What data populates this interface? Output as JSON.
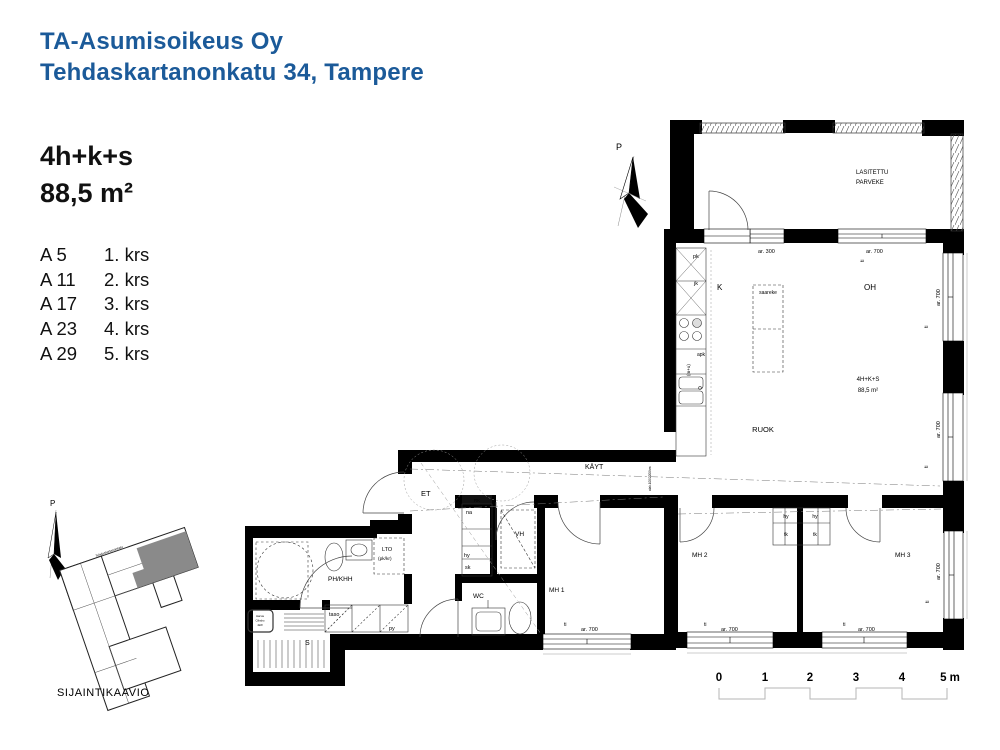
{
  "header": {
    "company": "TA-Asumisoikeus Oy",
    "address": "Tehdaskartanonkatu 34, Tampere"
  },
  "unit": {
    "type": "4h+k+s",
    "area": "88,5 m²"
  },
  "floors": [
    {
      "apt": "A 5",
      "floor": "1. krs"
    },
    {
      "apt": "A 11",
      "floor": "2. krs"
    },
    {
      "apt": "A 17",
      "floor": "3. krs"
    },
    {
      "apt": "A 23",
      "floor": "4. krs"
    },
    {
      "apt": "A 29",
      "floor": "5. krs"
    }
  ],
  "colors": {
    "accent_blue": "#1b5a99",
    "wall_black": "#000000",
    "site_highlight": "#8a8a8a"
  },
  "plan": {
    "labels": [
      {
        "name": "north-arrow-label",
        "text": "P",
        "x": 616,
        "y": 150,
        "size": 9
      },
      {
        "name": "balcony-label-line1",
        "text": "LASITETTU",
        "x": 856,
        "y": 174,
        "size": 6
      },
      {
        "name": "balcony-label-line2",
        "text": "PARVEKE",
        "x": 856,
        "y": 184,
        "size": 6
      },
      {
        "name": "dim-ar300",
        "text": "ar. 300",
        "x": 758,
        "y": 253,
        "size": 5.5
      },
      {
        "name": "dim-ar700-top",
        "text": "ar. 700",
        "x": 866,
        "y": 253,
        "size": 5.5
      },
      {
        "name": "sill-ti-top",
        "text": "ti",
        "x": 864,
        "y": 262,
        "size": 5,
        "rot": -90
      },
      {
        "name": "kitchen-freezer-label",
        "text": "pk",
        "x": 693,
        "y": 258,
        "size": 5.5
      },
      {
        "name": "kitchen-fridge-label",
        "text": "jk",
        "x": 694,
        "y": 285,
        "size": 5.5
      },
      {
        "name": "kitchen-label",
        "text": "K",
        "x": 717,
        "y": 290,
        "size": 8
      },
      {
        "name": "island-label",
        "text": "saareke",
        "x": 768,
        "y": 294,
        "size": 5,
        "anchor": "middle"
      },
      {
        "name": "livingroom-label",
        "text": "OH",
        "x": 864,
        "y": 290,
        "size": 8
      },
      {
        "name": "dishwasher-label",
        "text": "apk",
        "x": 697,
        "y": 356,
        "size": 5
      },
      {
        "name": "oven-micro-label",
        "text": "(m+u)",
        "x": 690,
        "y": 376,
        "size": 4.5,
        "rot": -90
      },
      {
        "name": "dim-ar700-right1",
        "text": "ar. 700",
        "x": 940,
        "y": 306,
        "size": 5.5,
        "rot": -90
      },
      {
        "name": "sill-ti-right1",
        "text": "ti",
        "x": 928,
        "y": 328,
        "size": 5,
        "rot": -90
      },
      {
        "name": "apartment-type-label",
        "text": "4H+K+S",
        "x": 868,
        "y": 381,
        "size": 6,
        "anchor": "middle"
      },
      {
        "name": "apartment-area-label",
        "text": "88,5 m²",
        "x": 868,
        "y": 392,
        "size": 6,
        "anchor": "middle"
      },
      {
        "name": "dining-label",
        "text": "RUOK",
        "x": 763,
        "y": 432,
        "size": 7.5,
        "anchor": "middle"
      },
      {
        "name": "dim-ar700-right2",
        "text": "ar. 700",
        "x": 940,
        "y": 438,
        "size": 5.5,
        "rot": -90
      },
      {
        "name": "sill-ti-right2",
        "text": "ti",
        "x": 928,
        "y": 468,
        "size": 5,
        "rot": -90
      },
      {
        "name": "hallway-label",
        "text": "KÄYT",
        "x": 585,
        "y": 469,
        "size": 7
      },
      {
        "name": "ceiling-note",
        "text": "alak.100/2200hm",
        "x": 651,
        "y": 491,
        "size": 3.2,
        "rot": -90,
        "color": "#444444"
      },
      {
        "name": "entrance-label",
        "text": "ET",
        "x": 421,
        "y": 496,
        "size": 7.5
      },
      {
        "name": "electric-panel-label",
        "text": "RK",
        "x": 477,
        "y": 502,
        "size": 4.4,
        "anchor": "middle",
        "color": "#ffffff"
      },
      {
        "name": "coatrack-label",
        "text": "na",
        "x": 466,
        "y": 514,
        "size": 5.5
      },
      {
        "name": "shelf-label",
        "text": "hy",
        "x": 464,
        "y": 557,
        "size": 5.5
      },
      {
        "name": "cleaning-closet-label",
        "text": "sk",
        "x": 465,
        "y": 569,
        "size": 5.5
      },
      {
        "name": "walkin-closet-label",
        "text": "VH",
        "x": 515,
        "y": 536,
        "size": 6.5
      },
      {
        "name": "lto-label",
        "text": "LTO",
        "x": 382,
        "y": 551,
        "size": 5.5
      },
      {
        "name": "lto-sub-label",
        "text": "(pk/kr)",
        "x": 378,
        "y": 560,
        "size": 4.8
      },
      {
        "name": "bathroom-utility-label",
        "text": "PH/KHH",
        "x": 328,
        "y": 581,
        "size": 6.5
      },
      {
        "name": "wc-label",
        "text": "WC",
        "x": 473,
        "y": 598,
        "size": 6.5
      },
      {
        "name": "bedroom1-label",
        "text": "MH 1",
        "x": 549,
        "y": 592,
        "size": 6.5
      },
      {
        "name": "counter-label",
        "text": "taso",
        "x": 329,
        "y": 616,
        "size": 5.5
      },
      {
        "name": "washer-label",
        "text": "py",
        "x": 389,
        "y": 630,
        "size": 5.5
      },
      {
        "name": "sauna-label",
        "text": "S",
        "x": 305,
        "y": 645,
        "size": 7
      },
      {
        "name": "heater-note-line1",
        "text": "Harvia",
        "x": 260,
        "y": 617,
        "size": 2.7,
        "anchor": "middle"
      },
      {
        "name": "heater-note-line2",
        "text": "Cilindro",
        "x": 260,
        "y": 621.5,
        "size": 2.7,
        "anchor": "middle"
      },
      {
        "name": "heater-note-line3",
        "text": "4kW",
        "x": 260,
        "y": 626,
        "size": 2.7,
        "anchor": "middle"
      },
      {
        "name": "sill-ti-mh1",
        "text": "ti",
        "x": 564,
        "y": 626,
        "size": 5
      },
      {
        "name": "dim-ar700-mh1",
        "text": "ar. 700",
        "x": 581,
        "y": 631,
        "size": 5.5
      },
      {
        "name": "wardrobe-hy-left",
        "text": "hy",
        "x": 786,
        "y": 518,
        "size": 5,
        "anchor": "middle"
      },
      {
        "name": "wardrobe-hy-right",
        "text": "hy",
        "x": 815,
        "y": 518,
        "size": 5,
        "anchor": "middle"
      },
      {
        "name": "wardrobe-tk-left",
        "text": "tk",
        "x": 786,
        "y": 536,
        "size": 5,
        "anchor": "middle"
      },
      {
        "name": "wardrobe-tk-right",
        "text": "tk",
        "x": 815,
        "y": 536,
        "size": 5,
        "anchor": "middle"
      },
      {
        "name": "bedroom2-label",
        "text": "MH 2",
        "x": 692,
        "y": 557,
        "size": 6.5
      },
      {
        "name": "bedroom3-label",
        "text": "MH 3",
        "x": 895,
        "y": 557,
        "size": 6.5
      },
      {
        "name": "sill-ti-mh2",
        "text": "ti",
        "x": 704,
        "y": 626,
        "size": 5
      },
      {
        "name": "dim-ar700-mh2",
        "text": "ar. 700",
        "x": 721,
        "y": 631,
        "size": 5.5
      },
      {
        "name": "sill-ti-mh3",
        "text": "ti",
        "x": 843,
        "y": 626,
        "size": 5
      },
      {
        "name": "dim-ar700-mh3",
        "text": "ar. 700",
        "x": 858,
        "y": 631,
        "size": 5.5
      },
      {
        "name": "dim-ar700-mh3-right",
        "text": "ar. 700",
        "x": 940,
        "y": 580,
        "size": 5.5,
        "rot": -90
      },
      {
        "name": "sill-ti-mh3-right",
        "text": "ti",
        "x": 929,
        "y": 603,
        "size": 5,
        "rot": -90
      },
      {
        "name": "site-north-label",
        "text": "P",
        "x": 50,
        "y": 506,
        "size": 8
      },
      {
        "name": "site-street-label",
        "text": "Tehdaskartanonkatu",
        "x": 96,
        "y": 557,
        "size": 3.2,
        "rot": -19,
        "color": "#888888"
      },
      {
        "name": "site-caption",
        "text": "SIJAINTIKAAVIO",
        "x": 57,
        "y": 696,
        "size": 11,
        "ls": 0.6
      },
      {
        "name": "scale-tick-0",
        "text": "0",
        "x": 719,
        "y": 681,
        "size": 11.5,
        "bold": true,
        "anchor": "middle"
      },
      {
        "name": "scale-tick-1",
        "text": "1",
        "x": 765,
        "y": 681,
        "size": 11.5,
        "bold": true,
        "anchor": "middle"
      },
      {
        "name": "scale-tick-2",
        "text": "2",
        "x": 810,
        "y": 681,
        "size": 11.5,
        "bold": true,
        "anchor": "middle"
      },
      {
        "name": "scale-tick-3",
        "text": "3",
        "x": 856,
        "y": 681,
        "size": 11.5,
        "bold": true,
        "anchor": "middle"
      },
      {
        "name": "scale-tick-4",
        "text": "4",
        "x": 902,
        "y": 681,
        "size": 11.5,
        "bold": true,
        "anchor": "middle"
      },
      {
        "name": "scale-tick-5m",
        "text": "5 m",
        "x": 950,
        "y": 681,
        "size": 11.5,
        "bold": true,
        "anchor": "middle"
      }
    ]
  }
}
